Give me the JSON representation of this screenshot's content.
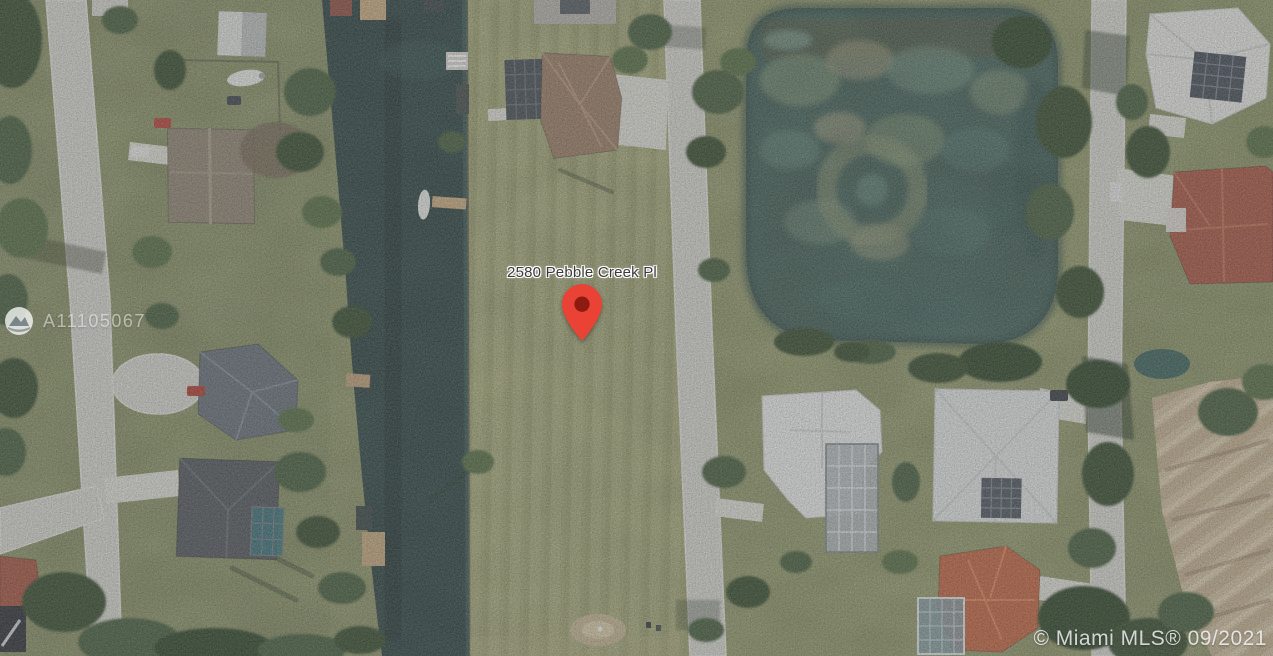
{
  "map_label": {
    "address": "2580 Pebble Creek Pl"
  },
  "pin": {
    "color": "#EA4335",
    "inner_color": "#8E1B0F"
  },
  "watermark": {
    "listing_id": "A11105067",
    "copyright": "© Miami MLS® 09/2021"
  },
  "palette": {
    "grass_base": "#8d985f",
    "lot_grass": "#a8ae6f",
    "canal_water": "#274644",
    "pond_water": "#42685d",
    "road": "#d6d6d0",
    "dirt": "#cdbb9b"
  }
}
